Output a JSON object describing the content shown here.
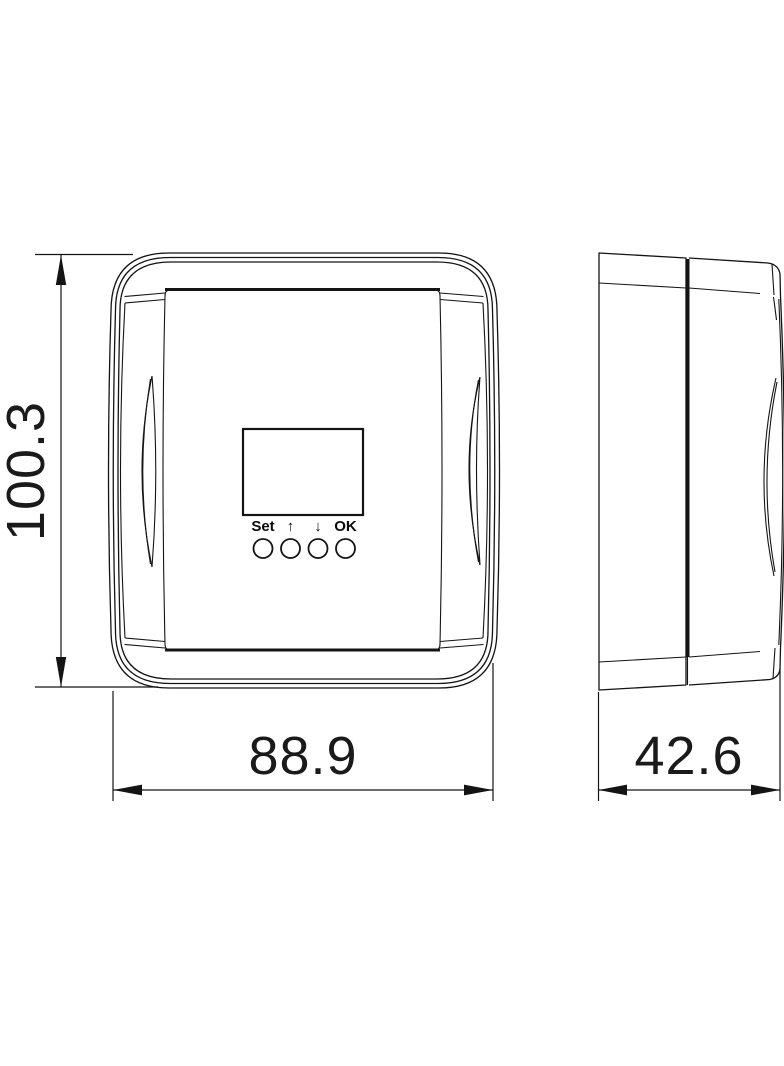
{
  "page": {
    "background_color": "#ffffff",
    "line_color": "#141414",
    "description": "Technical dimension drawing of wall-mounted controller, front and side views"
  },
  "front_view": {
    "display": {
      "name": "lcd-display"
    },
    "buttons": [
      {
        "label": "Set"
      },
      {
        "label": "↑"
      },
      {
        "label": "↓"
      },
      {
        "label": "OK"
      }
    ]
  },
  "side_view": {
    "name": "side-profile"
  },
  "dimensions": {
    "height": {
      "value": "100.3"
    },
    "width": {
      "value": "88.9"
    },
    "depth": {
      "value": "42.6"
    }
  }
}
